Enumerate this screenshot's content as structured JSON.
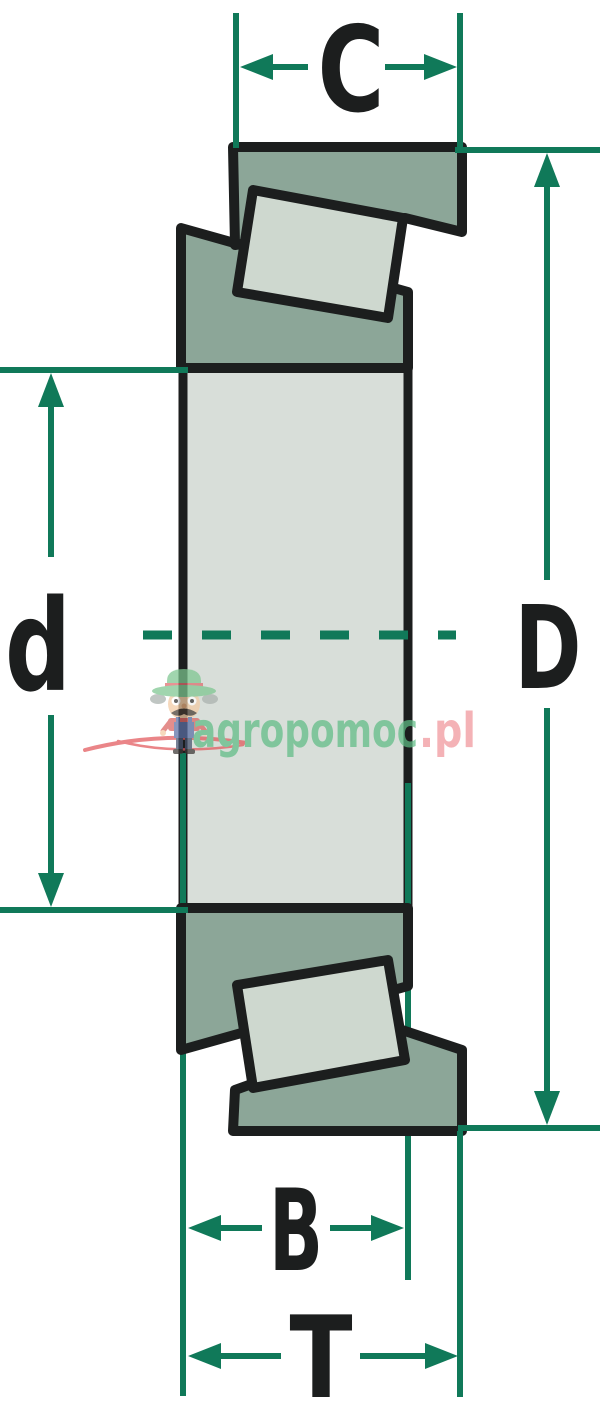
{
  "diagram": {
    "labels": {
      "cup_width": "C",
      "outer_diameter": "D",
      "bore": "d",
      "cone_width": "B",
      "total_width": "T"
    }
  },
  "watermark": {
    "brand_green": "agropomoc",
    "brand_pink": ".pl",
    "mascot": "farmer-mascot-icon"
  },
  "colors": {
    "dimension_teal": "#107959",
    "outline_black": "#1C1E1E",
    "ring_sage": "#8CA698",
    "roller_light": "#CED8CF",
    "body_light": "#D8DED9",
    "watermark_green": "#5FBC85",
    "watermark_pink": "#F0959B",
    "swoosh_red": "#E2575B",
    "background": "#FFFFFF"
  }
}
